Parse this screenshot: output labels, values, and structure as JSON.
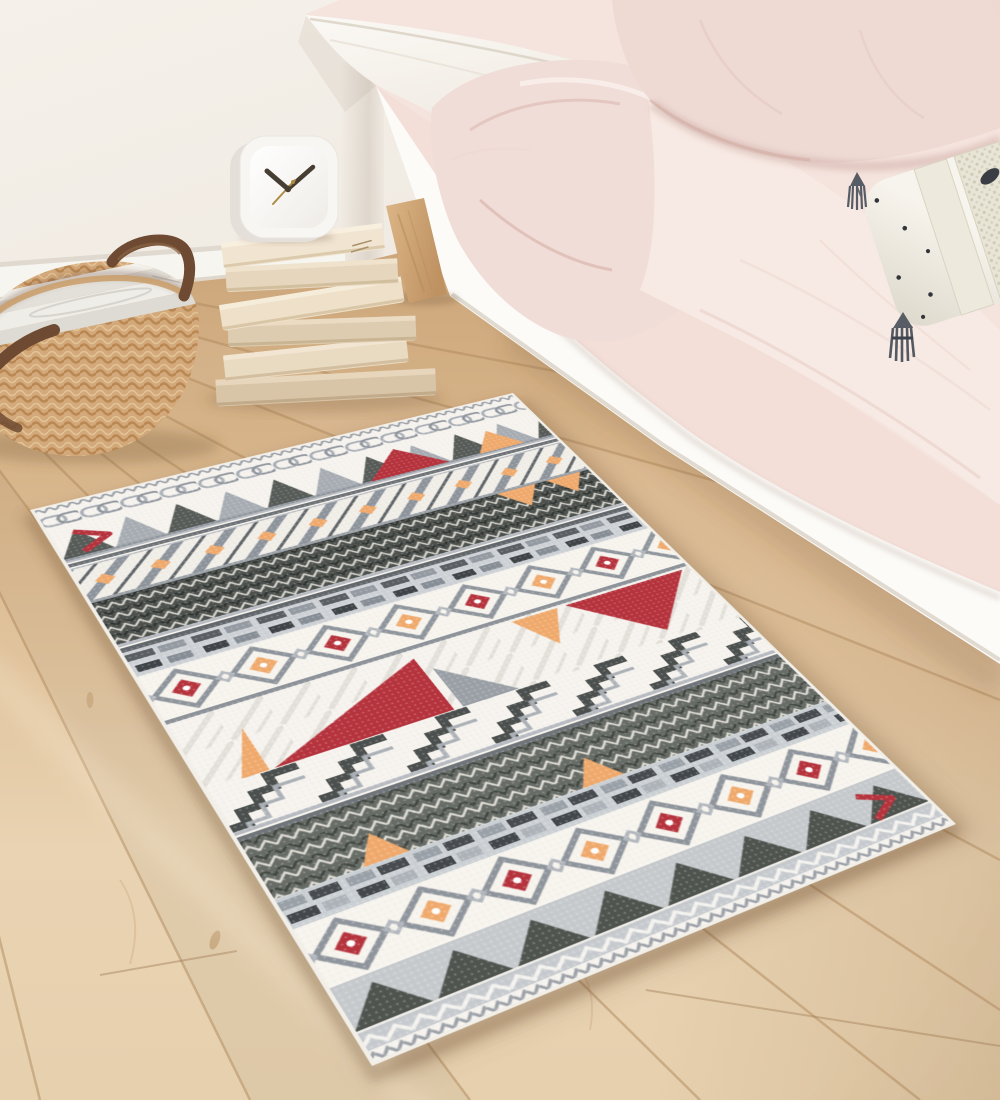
{
  "canvas": {
    "width": 1000,
    "height": 1100
  },
  "scene": {
    "label": "Bedroom lifestyle photo: bohemian geometric area rug on light oak floor beside a low white bed"
  },
  "palette": {
    "wall": "#f2ede6",
    "baseboard": "#f7f5f0",
    "floor_light": "#ecd9bc",
    "floor_mid": "#dcbb92",
    "floor_dark": "#cda77b",
    "floor_seam": "#b08a5e",
    "bed_frame": "#fcfbf8",
    "bedding_pink": "#f3e0da",
    "pillow_pink": "#eed9d3",
    "sheet_white": "#faf8f4",
    "pillow_cream": "#f7f4ed",
    "tassel_gray": "#585d65",
    "basket_tan": "#dcb283",
    "leather_brown": "#6d4a31",
    "book_cream": "#ecddc6",
    "clock_white": "#f8f6f2",
    "rug_ground": "#f7f4ee",
    "rug_gray": "#9aa0a6",
    "rug_charcoal": "#4e524f",
    "rug_red": "#b6333d",
    "rug_orange": "#f0aa6d"
  },
  "clock": {
    "time_shown": "10:09"
  },
  "objects": {
    "wall": {
      "label": "warm white bedroom wall"
    },
    "baseboard": {
      "label": "white baseboard"
    },
    "floor": {
      "label": "light oak plank floor"
    },
    "rug": {
      "label": "bohemian geometric area rug in cream, gray, charcoal, red and apricot"
    },
    "basket": {
      "label": "round woven seagrass basket with dark leather handles"
    },
    "magazines": {
      "label": "magazines and papers stacked in basket"
    },
    "books": {
      "label": "stack of cream paperback books"
    },
    "clock": {
      "label": "white rounded-square desk clock showing about 10:09"
    },
    "bed_frame": {
      "label": "white wooden bed side rail"
    },
    "bed_leg": {
      "label": "angled light wood bed leg"
    },
    "sheet": {
      "label": "white flat sheet corner"
    },
    "duvet": {
      "label": "blush pink duvet"
    },
    "bed_surface": {
      "label": "blush pink bedding surface"
    },
    "pillow_pink": {
      "label": "blush pink pillow"
    },
    "pillow_dotted": {
      "label": "cream pillow with black dots, knitted band and gray tassels"
    },
    "tassel": {
      "label": "gray tassel"
    }
  },
  "rug": {
    "bands": [
      {
        "name": "edge-trim-top",
        "y": 0,
        "h": 12,
        "fill": "url(#patTrim)"
      },
      {
        "name": "chain",
        "y": 12,
        "h": 26,
        "fill": "url(#patChain)"
      },
      {
        "name": "triangles-a",
        "y": 38,
        "h": 50,
        "fill": "url(#patTriA)"
      },
      {
        "name": "sep-1a",
        "y": 88,
        "h": 3,
        "fill": "#b9bdc3"
      },
      {
        "name": "sep-1b",
        "y": 93,
        "h": 5,
        "fill": "#6d7277"
      },
      {
        "name": "sep-1c",
        "y": 100,
        "h": 2,
        "fill": "#b9bdc3"
      },
      {
        "name": "weave",
        "y": 102,
        "h": 48,
        "fill": "url(#patWeave)"
      },
      {
        "name": "sep-2",
        "y": 150,
        "h": 4,
        "fill": "#9aa0a6"
      },
      {
        "name": "herringbone-1",
        "y": 154,
        "h": 62,
        "fill": "url(#patHerr)"
      },
      {
        "name": "sep-3a",
        "y": 216,
        "h": 4,
        "fill": "#b9bdc3"
      },
      {
        "name": "sep-3b",
        "y": 222,
        "h": 6,
        "fill": "#62676c"
      },
      {
        "name": "fret",
        "y": 228,
        "h": 34,
        "fill": "url(#patFret)"
      },
      {
        "name": "medallions-1",
        "y": 262,
        "h": 60,
        "fill": "url(#patMedal)"
      },
      {
        "name": "sep-4",
        "y": 322,
        "h": 5,
        "fill": "#8d9399"
      },
      {
        "name": "triangles-big",
        "y": 327,
        "h": 84,
        "fill": "url(#patTriBigBg)"
      },
      {
        "name": "stairs",
        "y": 411,
        "h": 50,
        "fill": "url(#patStair)"
      },
      {
        "name": "sep-5a",
        "y": 461,
        "h": 4,
        "fill": "#b9bdc3"
      },
      {
        "name": "sep-5b",
        "y": 467,
        "h": 5,
        "fill": "#70757a"
      },
      {
        "name": "herringbone-2",
        "y": 472,
        "h": 64,
        "fill": "url(#patHerr2)"
      },
      {
        "name": "bricks",
        "y": 536,
        "h": 32,
        "fill": "url(#patBrick)"
      },
      {
        "name": "medallions-2",
        "y": 568,
        "h": 60,
        "fill": "url(#patMedal)"
      },
      {
        "name": "triangle-row",
        "y": 628,
        "h": 46,
        "fill": "url(#patTriRow)"
      },
      {
        "name": "zigzag-light",
        "y": 674,
        "h": 14,
        "fill": "url(#patZigLight)"
      },
      {
        "name": "edge-trim-bottom",
        "y": 688,
        "h": 12,
        "fill": "url(#patTrim)"
      }
    ],
    "accents": [
      {
        "el": "polyline",
        "points": "22,48 48,64 22,80",
        "stroke": "#b6333d",
        "w": 7
      },
      {
        "el": "polygon",
        "points": "286,86 366,86 328,44",
        "fill": "#b6333d"
      },
      {
        "el": "polygon",
        "points": "398,86 446,86 422,52",
        "fill": "#f0aa6d"
      },
      {
        "el": "polygon",
        "points": "380,154 420,154 400,184",
        "fill": "#f0aa6d"
      },
      {
        "el": "polygon",
        "points": "432,154 468,154 450,182",
        "fill": "#f0aa6d"
      },
      {
        "el": "polygon",
        "points": "30,410 52,410 52,356",
        "fill": "#f0aa6d"
      },
      {
        "el": "polygon",
        "points": "56,410 206,410 206,338",
        "fill": "#b6333d"
      },
      {
        "el": "polygon",
        "points": "214,410 264,410 214,356",
        "fill": "#9aa0a6"
      },
      {
        "el": "polygon",
        "points": "300,330 344,330 322,374",
        "fill": "#f0aa6d"
      },
      {
        "el": "polygon",
        "points": "352,330 470,330 412,398",
        "fill": "#b6333d"
      },
      {
        "el": "polygon",
        "points": "70,536 106,536 88,506",
        "fill": "#f0aa6d"
      },
      {
        "el": "polygon",
        "points": "250,536 286,536 268,506",
        "fill": "#f0aa6d"
      },
      {
        "el": "polyline",
        "points": "430,640 454,654 430,668",
        "stroke": "#b6333d",
        "w": 6
      }
    ]
  }
}
